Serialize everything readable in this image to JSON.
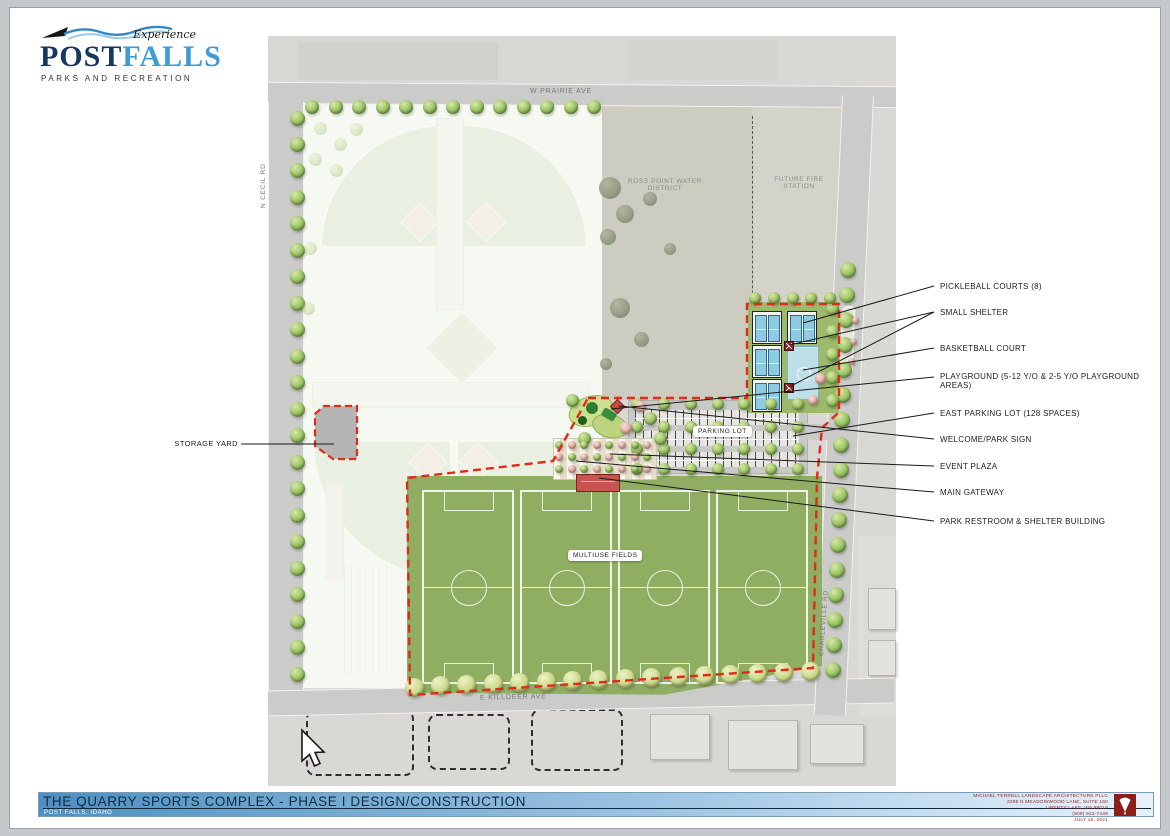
{
  "logo": {
    "experience": "Experience",
    "post": "POST",
    "falls": "FALLS",
    "tagline": "PARKS AND RECREATION"
  },
  "plan": {
    "roads": {
      "prairie": "W PRAIRIE AVE",
      "cecil": "N CECIL RD",
      "killdeer": "E KILLDEER AVE",
      "charleville": "CHARLEVILLE RD"
    },
    "areas": {
      "ross_point": "ROSS POINT WATER DISTRICT",
      "fire_station": "FUTURE FIRE STATION",
      "parking_lot": "PARKING LOT",
      "multiuse_fields": "MULTIUSE FIELDS",
      "storage_yard": "STORAGE YARD"
    }
  },
  "callouts": [
    "PICKLEBALL COURTS (8)",
    "SMALL SHELTER",
    "BASKETBALL COURT",
    "PLAYGROUND (5-12 Y/O & 2-5 Y/O PLAYGROUND AREAS)",
    "EAST PARKING LOT (128 SPACES)",
    "WELCOME/PARK SIGN",
    "EVENT PLAZA",
    "MAIN GATEWAY",
    "PARK RESTROOM & SHELTER BUILDING"
  ],
  "titleblock": {
    "title": "THE QUARRY SPORTS COMPLEX - PHASE I DESIGN/CONSTRUCTION",
    "subtitle": "POST FALLS, IDAHO"
  },
  "firm": {
    "lines": [
      "MICHAEL TERRELL LANDSCAPE ARCHITECTURE PLLC",
      "2295 N MEADOWWOOD LANE, SUITE 150",
      "LIBERTY LAKE, WA 99019",
      "(509) 922-7449",
      "JULY 15, 2021"
    ]
  },
  "colors": {
    "boundary_red": "#e02a1a",
    "field_green": "#8fae62",
    "court_blue": "#8ecbe2",
    "title_blue": "#4e8fc0",
    "firm_maroon": "#8c1f17"
  }
}
